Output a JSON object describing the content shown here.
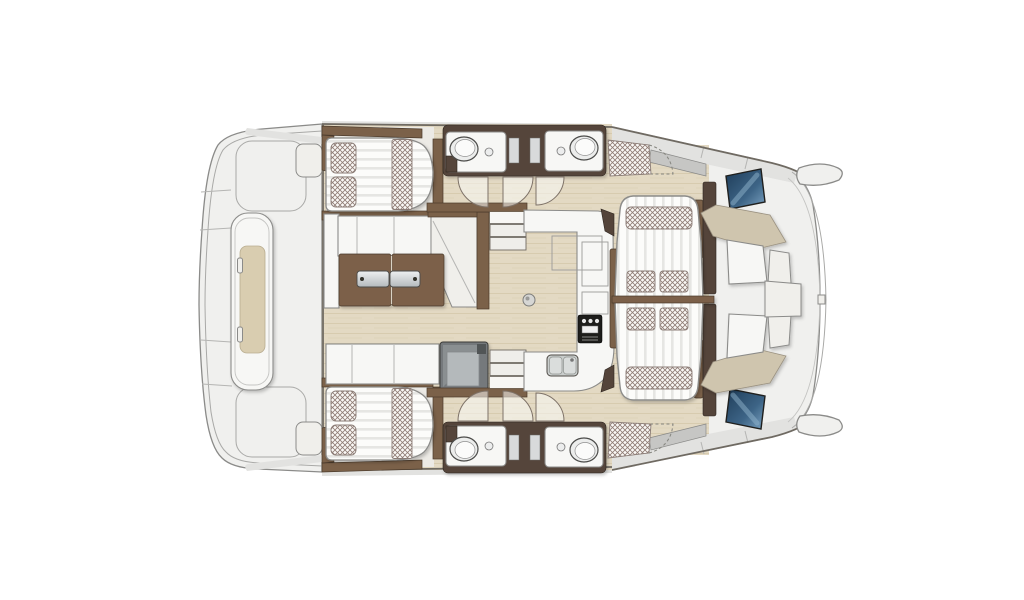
{
  "meta": {
    "description": "Top-down interior floor plan of a catamaran yacht: two cabins with double beds, two bathrooms with sinks, central salon with sofa and table, galley with stove and sink, amidships sunbed lounge with pillows, forward cockpit with benches, bow tips and aft deck platform with lounge seat"
  },
  "colors": {
    "deck": "#f0f0ee",
    "band": "#e2e2e0",
    "outline": "#8b8b89",
    "outline_light": "#a9a9a7",
    "outline_dark": "#6f6a62",
    "wood": "#e3d9c3",
    "wood_grain": "#d3c7a8",
    "walnut": "#7b6149",
    "walnut_dark": "#4a3a2b",
    "wall_dark": "#54443a",
    "furn_white": "#f7f7f5",
    "beige": "#cfc5ae",
    "beige_light": "#d9cdb0",
    "checker": "#8f7b74",
    "stripe": "#e6e6e3",
    "glass_gray": "#c6c6c4",
    "stove": "#1d1d1b",
    "window_blue_dark": "#1e3c58",
    "window_blue_light": "#7ba3c2",
    "steel_light": "#eef0f1",
    "steel_dark": "#b4babd"
  }
}
